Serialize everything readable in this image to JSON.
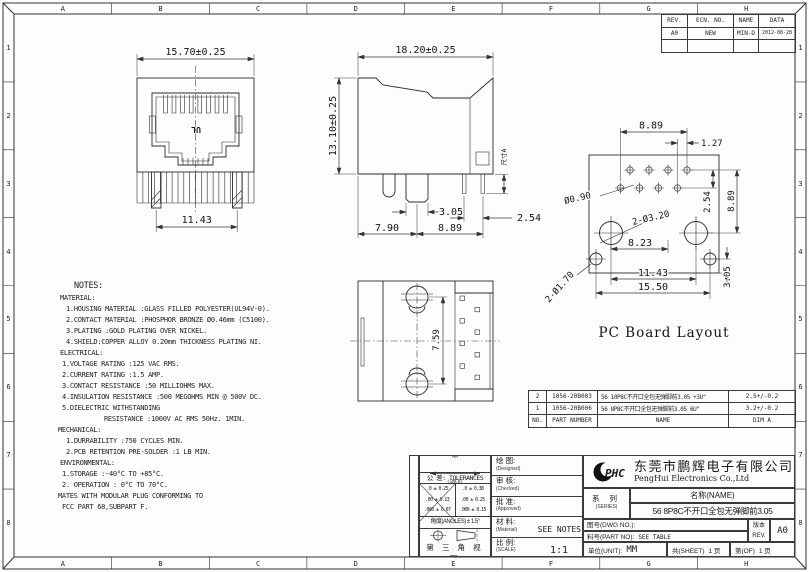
{
  "frame": {
    "cols": [
      "A",
      "B",
      "C",
      "D",
      "E",
      "F",
      "G",
      "H"
    ],
    "rows": [
      "1",
      "2",
      "3",
      "4",
      "5",
      "6",
      "7",
      "8"
    ]
  },
  "revision_table": {
    "headers": [
      "REV.",
      "ECN. NO.",
      "NAME",
      "DATA"
    ],
    "rows": [
      [
        "A0",
        "NEW",
        "MIN-D",
        "2012-08-28"
      ],
      [
        "",
        "",
        "",
        ""
      ]
    ]
  },
  "views": {
    "front": {
      "width": "15.70±0.25",
      "pin_span": "11.43",
      "ul_mark": "UL"
    },
    "side": {
      "width": "18.20±0.25",
      "height": "13.10±0.25",
      "peg_width": "3.05",
      "pin_pitch": "2.54",
      "front_span": "7.90",
      "rear_span": "8.89",
      "dim_a": "尺寸A"
    },
    "board": {
      "caption": "PC Board Layout",
      "pin_span": "8.89",
      "row_offset": "1.27",
      "pin_hole": "Ø0.90",
      "post_hole": "2-Ø3.20",
      "post_offset": "8.23",
      "row_pitch": "2.54",
      "col_span": "8.89",
      "post_span": "11.43",
      "mount_span": "15.50",
      "mount_hole": "2-Ø1.70",
      "edge_offset": "3.05"
    },
    "top": {
      "post_span": "7.59"
    }
  },
  "notes": {
    "title": "NOTES:",
    "lines": [
      "MATERIAL:",
      "1.HOUSING MATERIAL :GLASS FILLED POLYESTER(UL94V-0).",
      "2.CONTACT MATERIAL :PHOSPHOR BRONZE Ø0.46mm (C5100).",
      "3.PLATING :GOLD PLATING OVER NICKEL.",
      "4.SHIELD:COPPER ALLOY 0.20mm THICKNESS PLATING NI.",
      "ELECTRICAL:",
      "1.VOLTAGE RATING :125 VAC RMS.",
      "2.CURRENT RATING :1.5 AMP.",
      "3.CONTACT RESISTANCE :50 MILLIOHMS MAX.",
      "4.INSULATION RESISTANCE :500 MEGOHMS MIN @ 500V DC.",
      "5.DIELECTRIC WITHSTANDING",
      "RESISTANCE :1000V AC RMS 50Hz. 1MIN.",
      "MECHANICAL:",
      "1.DURRABILITY :750 CYCLES MIN.",
      "2.PCB RETENTION PRE-SOLDER :1 LB MIN.",
      "ENVIRONMENTAL:",
      "1.STORAGE :-40°C TO +85°C.",
      "2. OPERATION : 0°C TO 70°C.",
      "MATES WITH MODULAR PLUG CONFORMING TO",
      "FCC PART 68,SUBPART F."
    ]
  },
  "parts_table": {
    "headers": [
      "NO.",
      "PART NUMBER",
      "NAME",
      "DIM A"
    ],
    "rows": [
      [
        "2",
        "1056-20B003",
        "56 10P8C不开口全包无弹脚前3.05 +3U\"",
        "2.5+/-0.2"
      ],
      [
        "1",
        "1056-20B006",
        "56 8P8C不开口全包无弹脚前3.05 6U\"",
        "3.2+/-0.2"
      ]
    ]
  },
  "title_block": {
    "tolerance": {
      "unit_top": "MM",
      "unit_bottom": "(INCH)",
      "label": "公 差: TOLERANCES",
      "rows_mm": [
        ".0 ± 0.25",
        ".00 ± 0.13",
        ".000 ± 0.07"
      ],
      "rows_in": [
        ".0 ± 0.38",
        ".00 ± 0.25",
        ".000 ± 0.15"
      ],
      "angles": "角度(ANGLES) ± 1.5°",
      "projection": "第 三 角 视 图"
    },
    "signoff": [
      {
        "cn": "绘  图:",
        "en": "(Designed)",
        "value": ""
      },
      {
        "cn": "审  核:",
        "en": "(Checked)",
        "value": ""
      },
      {
        "cn": "批  准:",
        "en": "(Approved)",
        "value": ""
      },
      {
        "cn": "材  料:",
        "en": "(Material)",
        "value": "SEE NOTES"
      },
      {
        "cn": "比  例:",
        "en": "(SCALE)",
        "value": "1:1"
      }
    ],
    "logo_text": "PHC",
    "company_cn": "东莞市鹏辉电子有限公司",
    "company_en": "PengHui Electronics Co.,Ltd",
    "series_cn": "系  列",
    "series_en": "(SERIES)",
    "name_label": "名称(NAME)",
    "name_value": "56 8P8C不开口全包无弹脚前3.05",
    "dwg_label": "图号(DWG NO.):",
    "dwg_value": "",
    "part_label": "料号(PART NO):",
    "part_value": "SEE TABLE",
    "rev_cn": "版本",
    "rev_en": "REV.",
    "rev_value": "A0",
    "unit_label": "单位(UNIT):",
    "unit_value": "MM",
    "sheet_label": "共(SHEET)",
    "sheet_value": "1 页",
    "of_label": "第(OF)",
    "of_value": "1 页"
  }
}
